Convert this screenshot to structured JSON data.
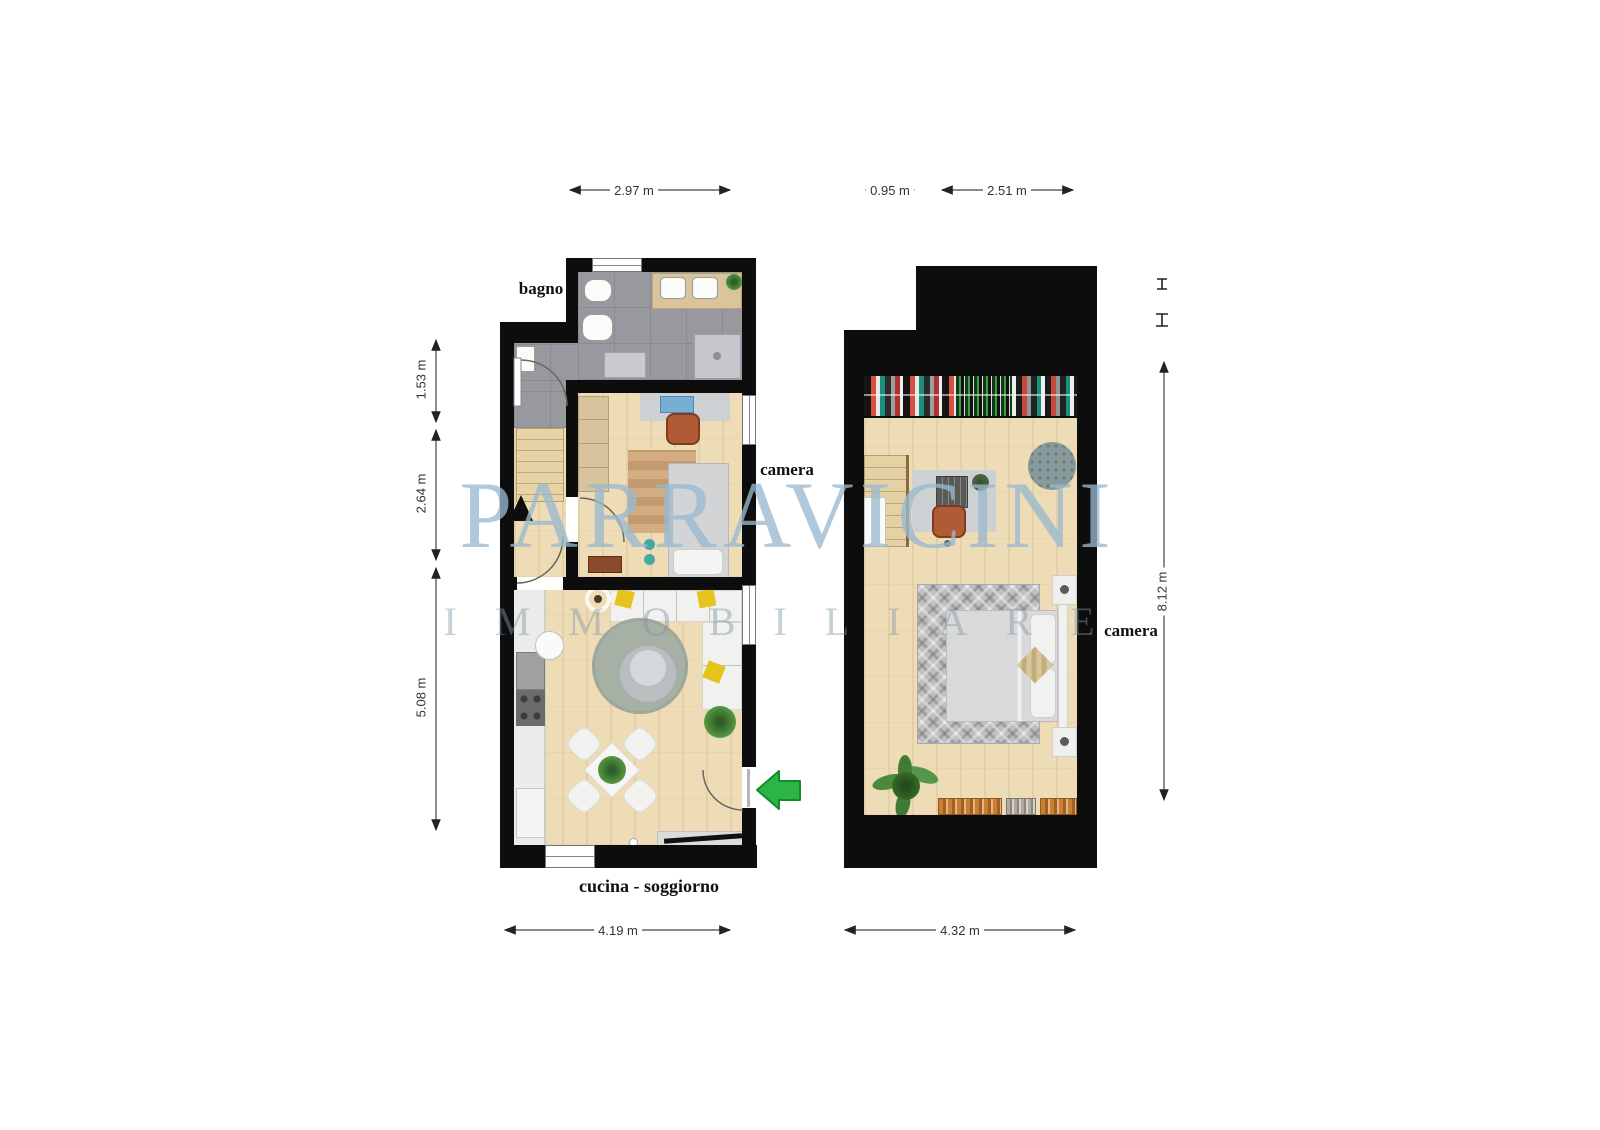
{
  "watermark": {
    "line1": "PARRAVICINI",
    "line2": "IMMOBILIARE"
  },
  "plans": {
    "left": {
      "name": "piano terra - cucina soggiorno, camera, bagno",
      "rooms": {
        "bathroom_label": "bagno",
        "bedroom_label": "camera",
        "kitchen_living_label": "cucina - soggiorno"
      },
      "dimensions": {
        "top_width": "2.97 m",
        "side_upper": "1.53 m",
        "side_middle": "2.64 m",
        "side_lower": "5.08 m",
        "bottom_width": "4.19 m"
      }
    },
    "right": {
      "name": "piano superiore - camera",
      "rooms": {
        "bedroom_label": "camera"
      },
      "dimensions": {
        "top_left_width": "0.95 m",
        "top_right_width": "2.51 m",
        "side_height": "8.12 m",
        "bottom_width": "4.32 m"
      }
    }
  },
  "colors": {
    "wall": "#0d0d0d",
    "wood_floor": "#eedcb6",
    "tile_floor": "#98999f",
    "entry_arrow_green": "#2cb546",
    "watermark_primary": "#9ab8d0",
    "watermark_secondary": "#7f96a6",
    "rug_green_gray": "#a6b0a5",
    "sofa_pillow_yellow": "#e4c41d"
  }
}
